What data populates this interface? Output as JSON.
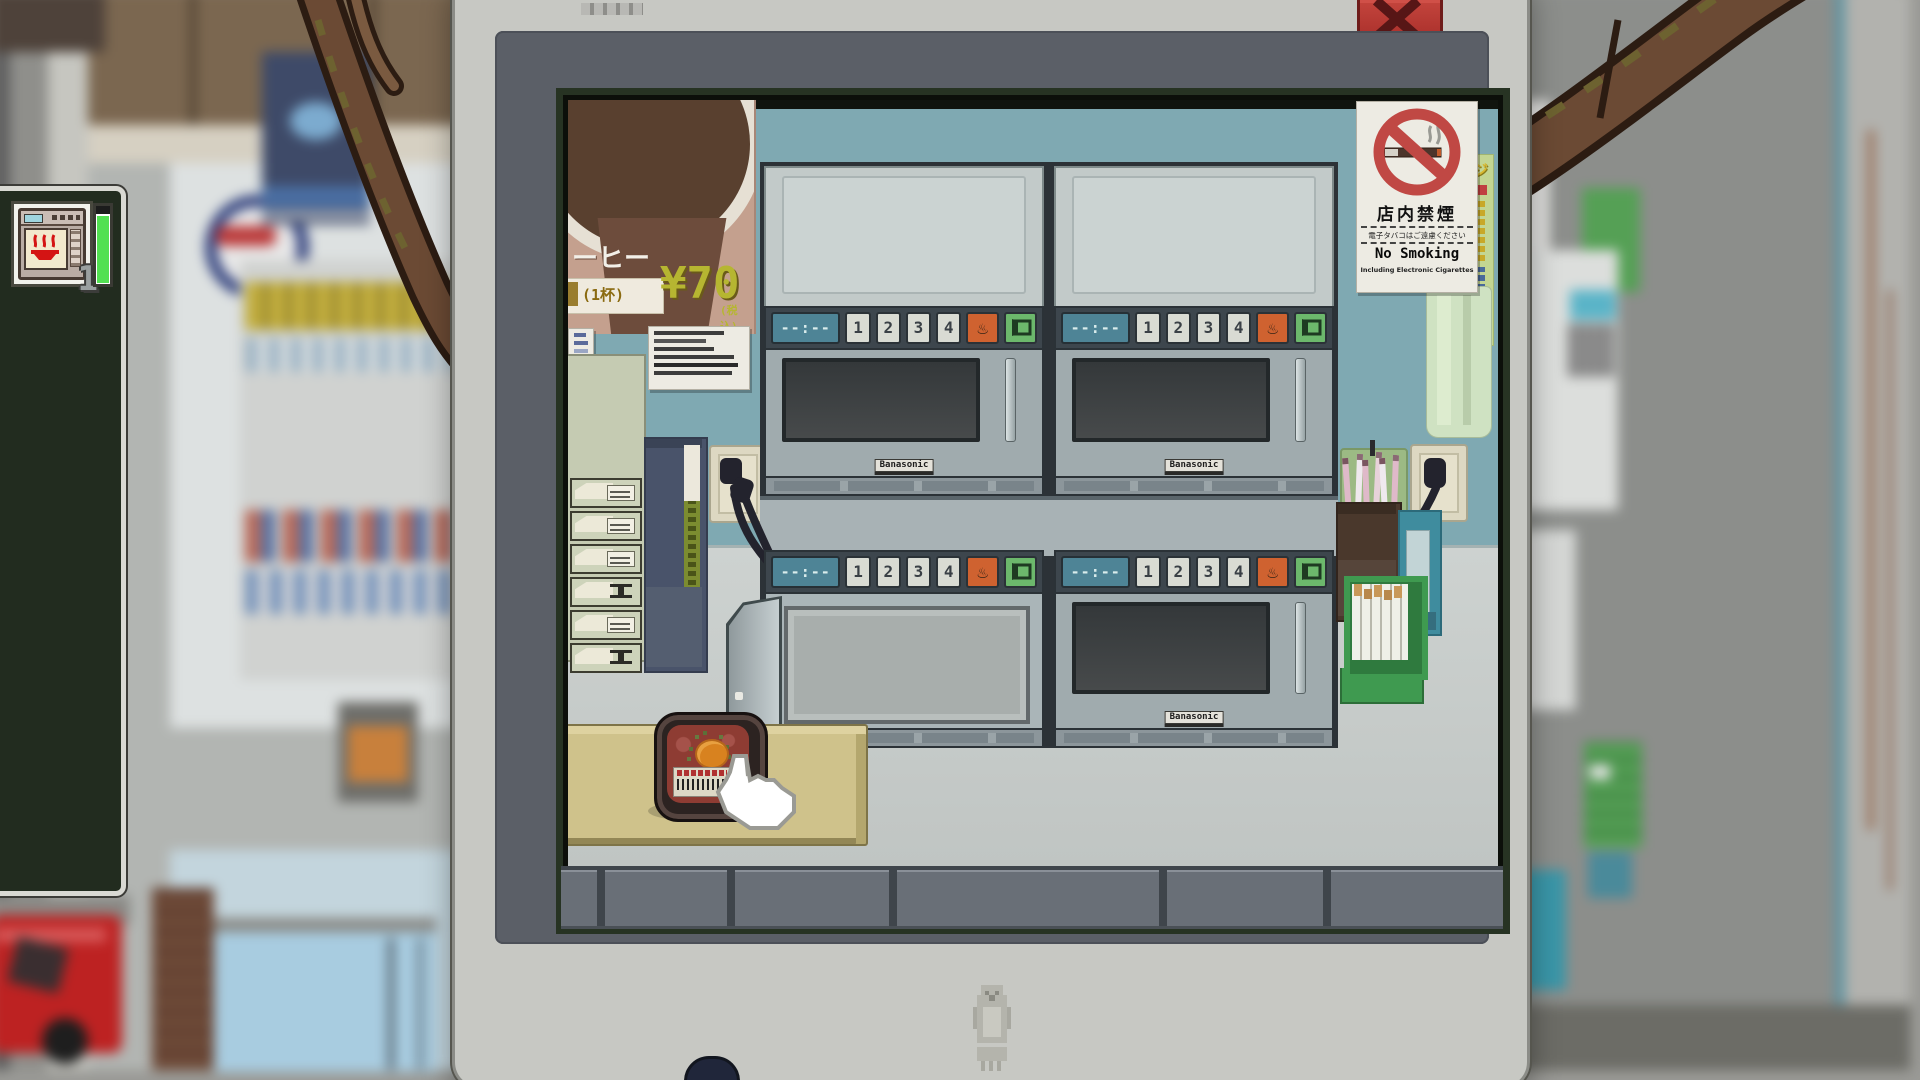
{
  "popup": {
    "close_icon": "✕",
    "brand_mark": "penguin"
  },
  "sidebar": {
    "slot_badge": "1",
    "progress_ratio": 0.92,
    "progress_color": "#52e052"
  },
  "scene": {
    "coffee_poster": {
      "title_fragment": "ーヒー",
      "serving": "(1杯)",
      "price": "¥70",
      "tax_note": "(税込)"
    },
    "no_smoking_sign": {
      "jp_title": "店内禁煙",
      "jp_note": "電子タバコはご遠慮ください",
      "en_title": "No Smoking",
      "en_note": "Including Electronic Cigarettes"
    },
    "side_poster_fragment": "ジ",
    "microwaves": {
      "display": "--:--",
      "buttons": [
        "1",
        "2",
        "3",
        "4"
      ],
      "heat_icon": "♨",
      "open_icon": "door-open",
      "brand_label": "Banasonic",
      "units": [
        {
          "id": "top-left",
          "door": "closed"
        },
        {
          "id": "top-right",
          "door": "closed"
        },
        {
          "id": "bottom-left",
          "door": "open"
        },
        {
          "id": "bottom-right",
          "door": "closed"
        }
      ]
    },
    "items": {
      "bento_box": "beef-bento-with-egg",
      "cursor": "hand-cursor"
    }
  },
  "colors": {
    "wall_teal": "#7fa9b2",
    "display_teal": "#4e8496",
    "accent_orange": "#cf6230",
    "accent_green": "#6cb86c",
    "close_red": "#b23230"
  }
}
